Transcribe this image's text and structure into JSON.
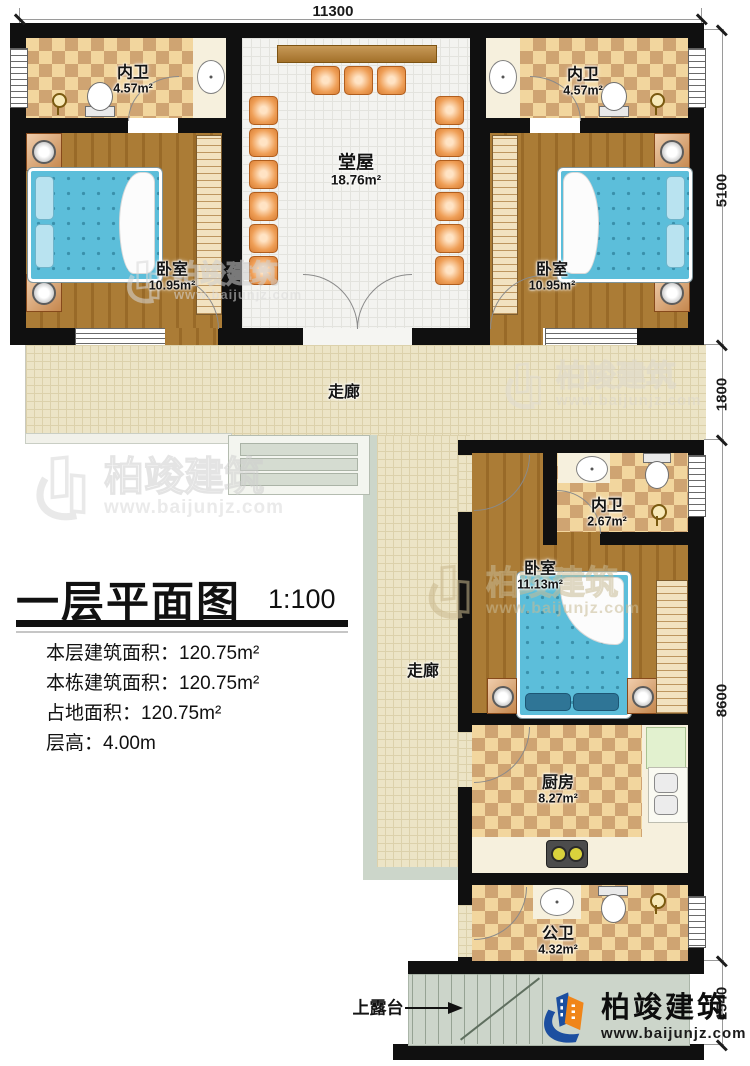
{
  "title_block": {
    "title": "一层平面图",
    "scale": "1:100",
    "info_lines": [
      {
        "label": "本层建筑面积：",
        "value": "120.75m²"
      },
      {
        "label": "本栋建筑面积：",
        "value": "120.75m²"
      },
      {
        "label": "占地面积：",
        "value": "120.75m²"
      },
      {
        "label": "层高：",
        "value": "4.00m"
      }
    ]
  },
  "dimensions": {
    "top_width": "11300",
    "right_heights": [
      "5100",
      "1800",
      "8600",
      "1540"
    ]
  },
  "rooms": {
    "bath_top_left": {
      "name": "内卫",
      "area": "4.57m²"
    },
    "bath_top_right": {
      "name": "内卫",
      "area": "4.57m²"
    },
    "hall": {
      "name": "堂屋",
      "area": "18.76m²"
    },
    "bedroom_left": {
      "name": "卧室",
      "area": "10.95m²"
    },
    "bedroom_right": {
      "name": "卧室",
      "area": "10.95m²"
    },
    "corridor_h": {
      "name": "走廊"
    },
    "corridor_v": {
      "name": "走廊"
    },
    "bath_mid": {
      "name": "内卫",
      "area": "2.67m²"
    },
    "bedroom_mid": {
      "name": "卧室",
      "area": "11.13m²"
    },
    "kitchen": {
      "name": "厨房",
      "area": "8.27m²"
    },
    "bath_public": {
      "name": "公卫",
      "area": "4.32m²"
    },
    "terrace_stairs": {
      "label": "上露台"
    }
  },
  "brand": {
    "name": "柏竣建筑",
    "url": "www.baijunjz.com"
  },
  "watermark": {
    "name": "柏竣建筑",
    "url": "www.baijunjz.com"
  },
  "colors": {
    "wall": "#101010",
    "brand_blue": "#1c4fa0",
    "brand_orange": "#f08519",
    "bed_blue": "#5cbeda",
    "wood_floor": "#a5752f",
    "corridor_tile": "#ece4c6",
    "bath_checker": "#cfa472"
  }
}
